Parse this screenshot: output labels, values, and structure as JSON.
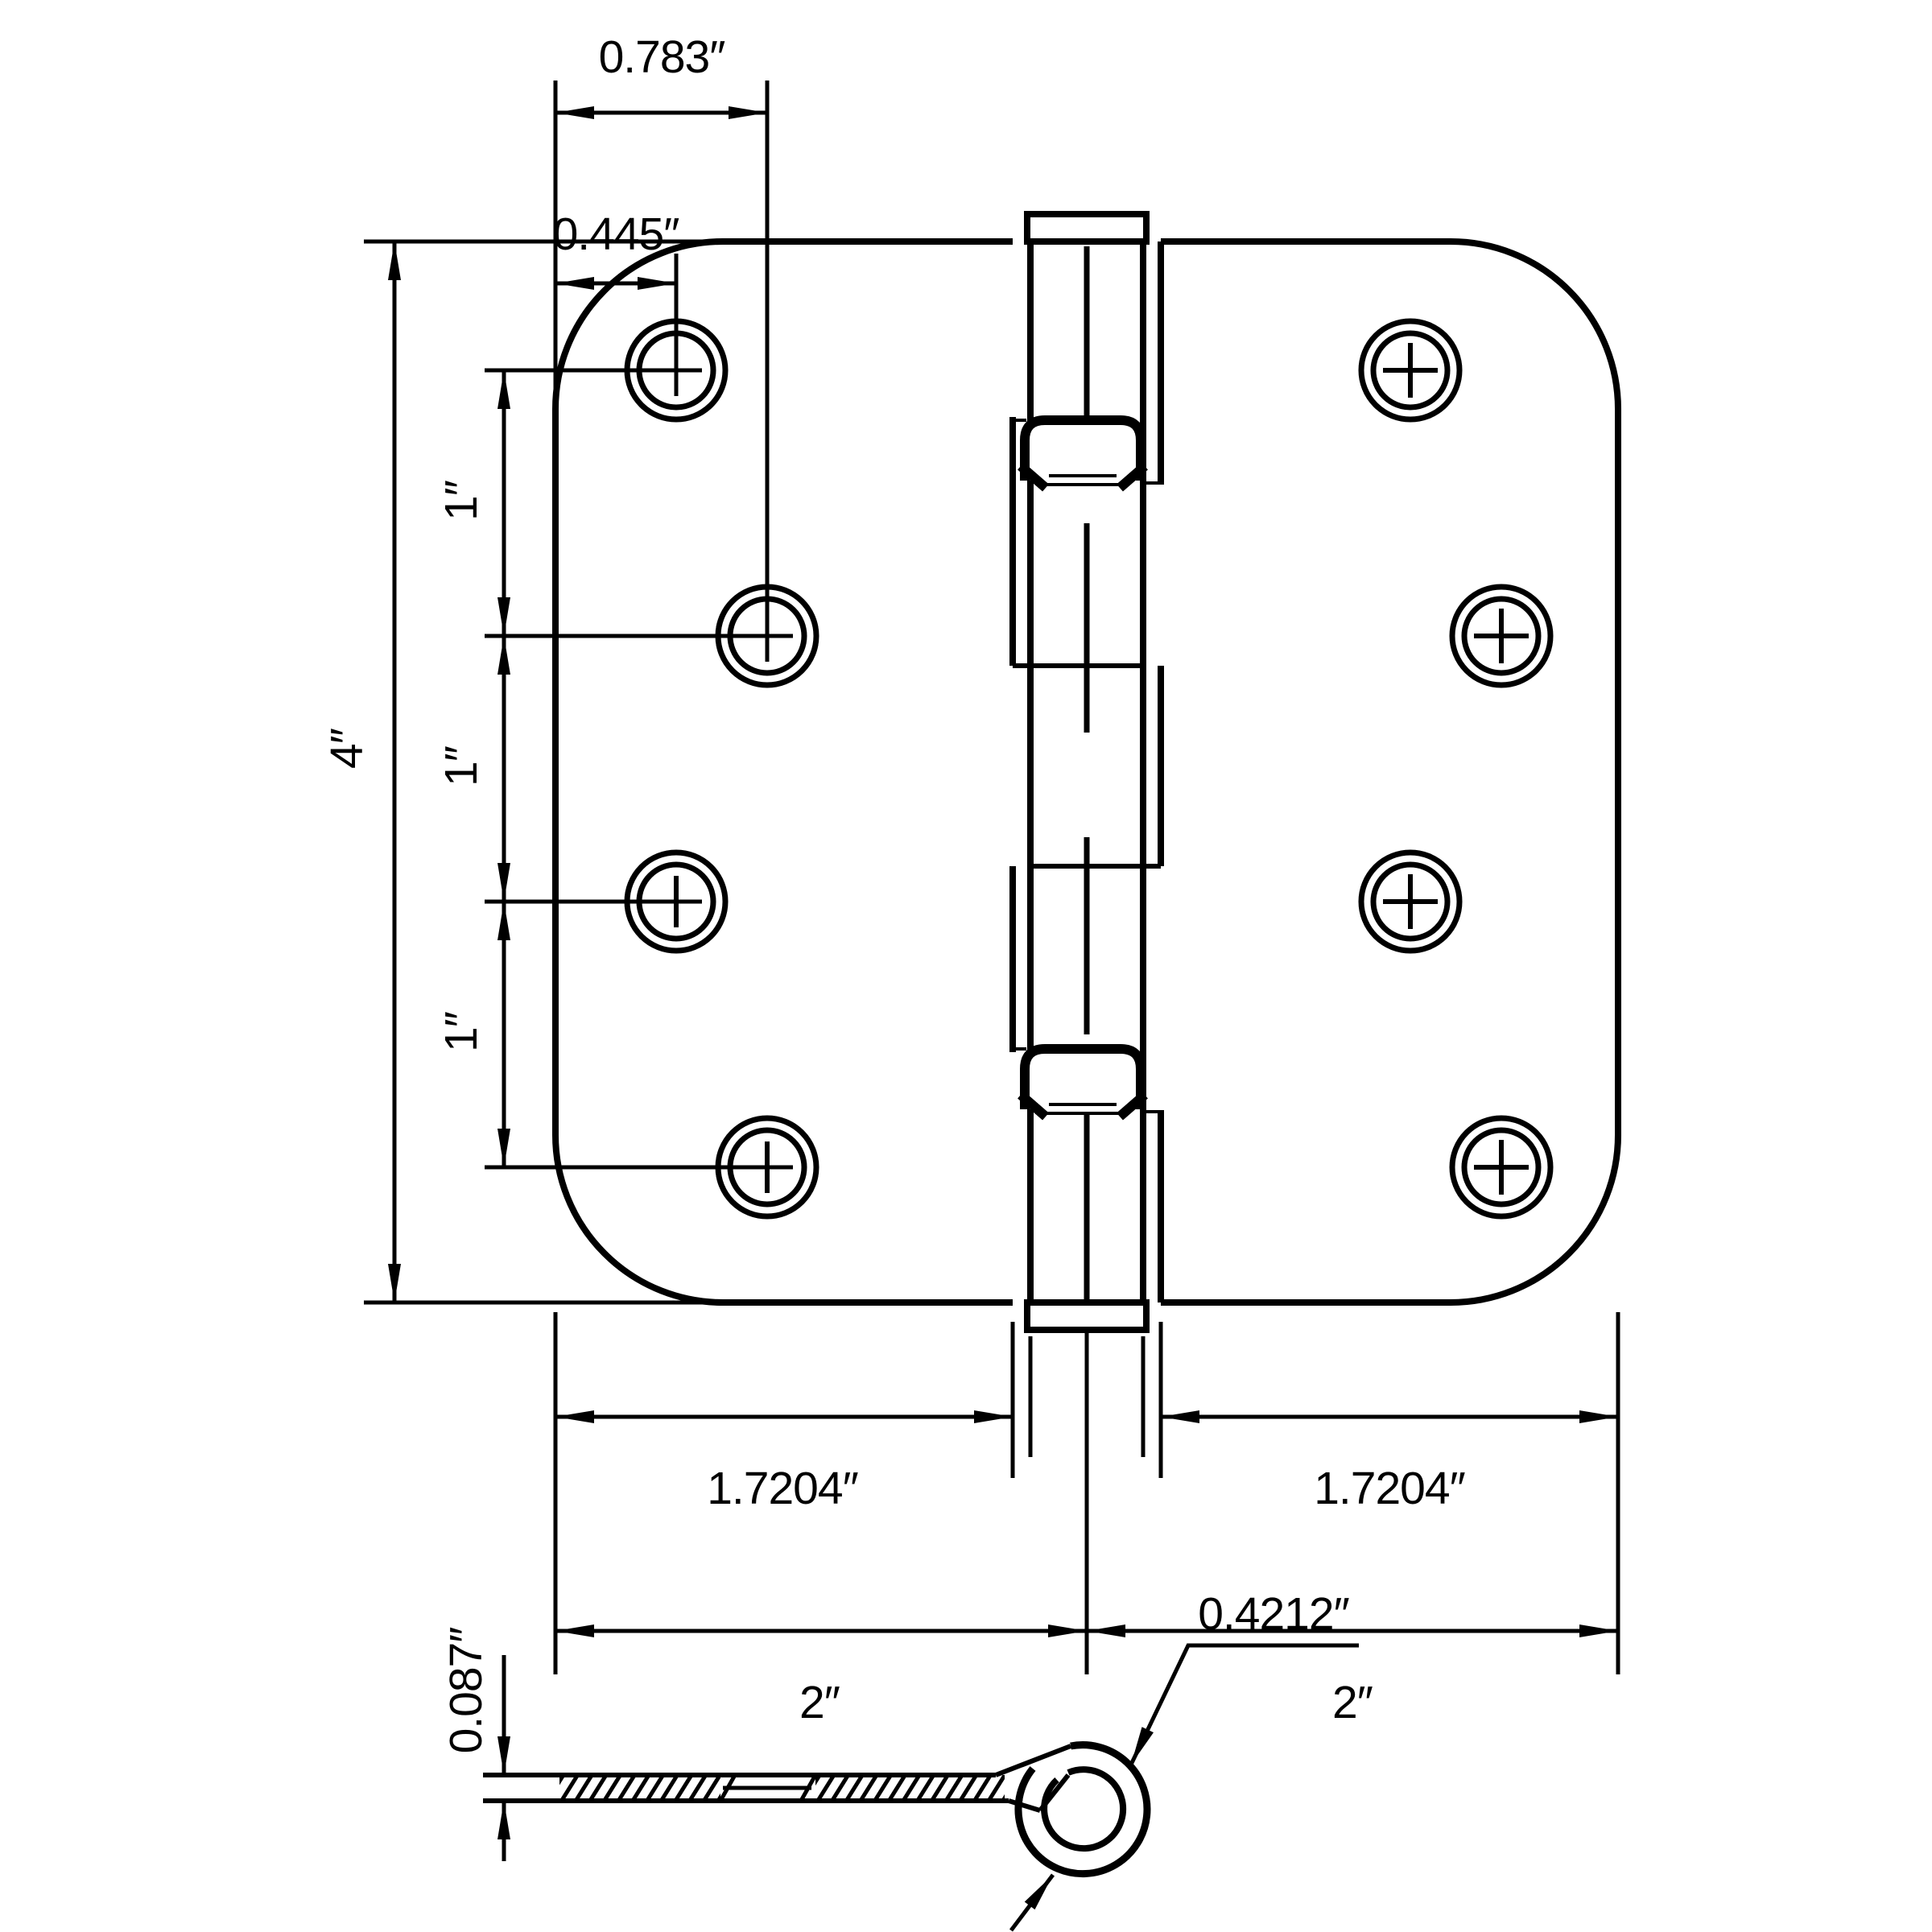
{
  "drawing": {
    "kind": "hinge-dimension-diagram",
    "colors": {
      "ink": "#000000",
      "paper": "#ffffff"
    },
    "front_view": {
      "dims": {
        "hole_col2_offset": "0.783″",
        "hole_col1_offset": "0.445″",
        "plate_height": "4″",
        "hole_pitch_top": "1″",
        "hole_pitch_mid": "1″",
        "hole_pitch_bottom": "1″",
        "left_leaf_width": "1.7204″",
        "right_leaf_width": "1.7204″",
        "left_half_width": "2″",
        "right_half_width": "2″"
      }
    },
    "profile_view": {
      "dims": {
        "leaf_thickness": "0.087″",
        "knuckle_diameter": "0.4212″"
      }
    }
  }
}
